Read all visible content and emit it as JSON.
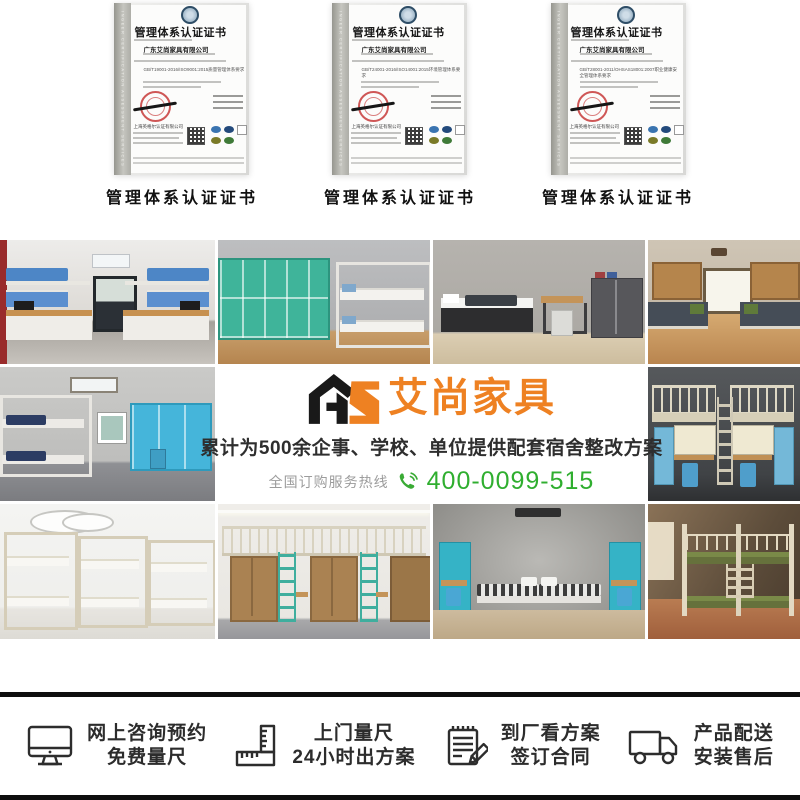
{
  "certificates": {
    "spine_text": "INGEER CERTIFICATION ASSESSMENT SERVICES",
    "issuer": "上海英格尔认证有限公司",
    "items": [
      {
        "title": "管理体系认证证书",
        "company": "广东艾尚家具有限公司",
        "standard": "GB/T19001-2016/ISO9001:2015质量管理体系要求",
        "caption": "管理体系认证证书"
      },
      {
        "title": "管理体系认证证书",
        "company": "广东艾尚家具有限公司",
        "standard": "GB/T24001-2016/ISO14001:2015环境管理体系要求",
        "caption": "管理体系认证证书"
      },
      {
        "title": "管理体系认证证书",
        "company": "广东艾尚家具有限公司",
        "standard": "GB/T28001-2011/OHSAS18001:2007职业健康安全管理体系要求",
        "caption": "管理体系认证证书"
      }
    ]
  },
  "promo": {
    "logo_mark": "AS",
    "logo_text": "艾尚家具",
    "tagline": "累计为500余企事、学校、单位提供配套宿舍整改方案",
    "hotline_label": "全国订购服务热线",
    "hotline_number": "400-0099-515",
    "colors": {
      "brand_orange": "#ee8122",
      "hotline_green": "#2fae2f"
    }
  },
  "gallery": {
    "photos": [
      "blue-bunk-dorm-symmetric",
      "teal-lockers-white-bunk",
      "gray-room-single-bed-cabinet",
      "wood-floor-wardrobe-beds",
      "gray-room-bunk-cyan-wardrobes",
      "dark-loft-desk-workstations",
      "cream-bunk-beds-row",
      "loft-beds-green-ladders",
      "gray-room-striped-beds-teal-doors",
      "army-green-bunk-beds"
    ]
  },
  "services": {
    "items": [
      {
        "icon": "monitor-icon",
        "line1": "网上咨询预约",
        "line2": "免费量尺"
      },
      {
        "icon": "ruler-icon",
        "line1": "上门量尺",
        "line2": "24小时出方案"
      },
      {
        "icon": "contract-icon",
        "line1": "到厂看方案",
        "line2": "签订合同"
      },
      {
        "icon": "truck-icon",
        "line1": "产品配送",
        "line2": "安装售后"
      }
    ]
  }
}
